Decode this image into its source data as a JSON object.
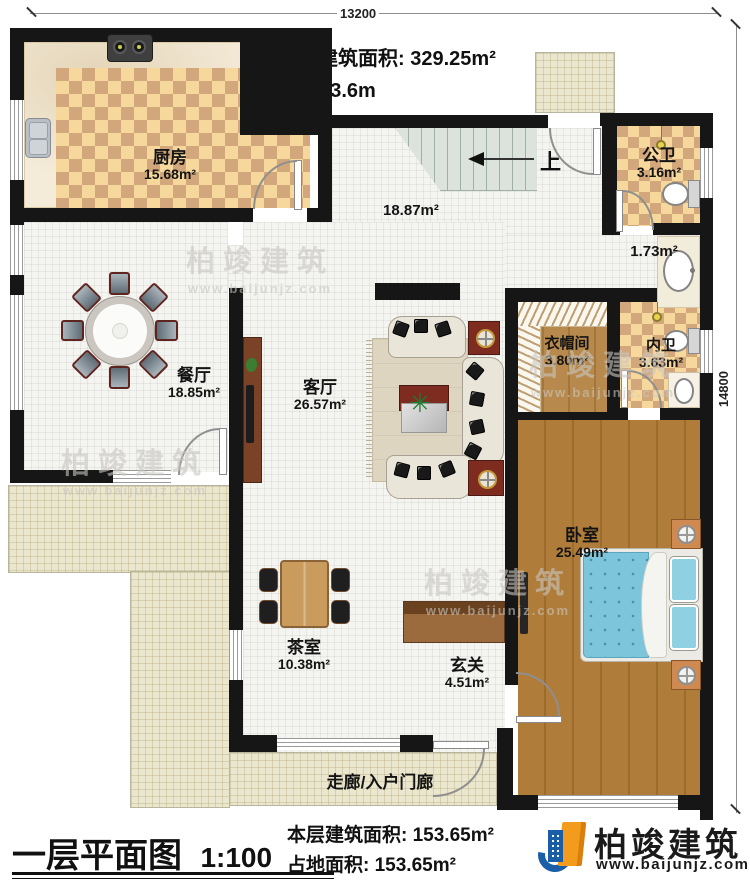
{
  "header": {
    "total_area_label": "本栋建筑面积:",
    "total_area_value": "329.25m²",
    "floor_height_label": "层高:",
    "floor_height_value": "3.6m"
  },
  "dimensions": {
    "width": "13200",
    "height": "14800"
  },
  "stairs": {
    "up": "上"
  },
  "rooms": {
    "kitchen": {
      "name": "厨房",
      "area": "15.68m²"
    },
    "stair_hall": {
      "area": "18.87m²"
    },
    "public_bath": {
      "name": "公卫",
      "area": "3.16m²"
    },
    "wash_nook": {
      "area": "1.73m²"
    },
    "dining": {
      "name": "餐厅",
      "area": "18.85m²"
    },
    "living": {
      "name": "客厅",
      "area": "26.57m²"
    },
    "cloakroom": {
      "name": "衣帽间",
      "area": "3.80m²"
    },
    "ensuite": {
      "name": "内卫",
      "area": "3.63m²"
    },
    "bedroom": {
      "name": "卧室",
      "area": "25.49m²"
    },
    "tea_room": {
      "name": "茶室",
      "area": "10.38m²"
    },
    "foyer": {
      "name": "玄关",
      "area": "4.51m²"
    },
    "porch": {
      "name": "走廊/入户门廊"
    }
  },
  "footer": {
    "plan_title": "一层平面图",
    "plan_scale": "1:100",
    "floor_area_label": "本层建筑面积:",
    "floor_area_value": "153.65m²",
    "site_area_label": "占地面积:",
    "site_area_value": "153.65m²"
  },
  "brand": {
    "name": "柏竣建筑",
    "site": "www.baijunjz.com"
  },
  "watermark": {
    "name": "柏竣建筑",
    "site": "www.baijunjz.com"
  },
  "colors": {
    "wall": "#161616",
    "checker_light": "#f6d89c",
    "checker_dark": "#d2a77b",
    "wood": "#b07c3a",
    "bed_blue": "#7cc5da",
    "accent_red": "#7e2c1f",
    "brand_blue": "#1b5ea8",
    "brand_orange": "#f29b1d"
  }
}
